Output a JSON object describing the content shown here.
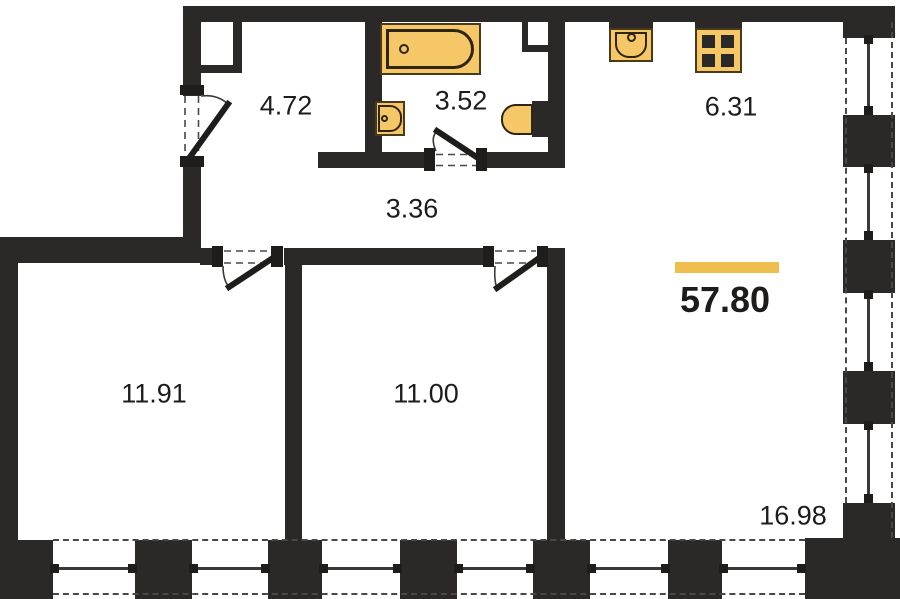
{
  "floor_plan": {
    "title": "apartment-floor-plan",
    "total_area": "57.80",
    "rooms": [
      {
        "name": "entry-hall",
        "area": "4.72"
      },
      {
        "name": "bathroom",
        "area": "3.52"
      },
      {
        "name": "corridor",
        "area": "3.36"
      },
      {
        "name": "kitchen",
        "area": "6.31"
      },
      {
        "name": "bedroom-1",
        "area": "11.91"
      },
      {
        "name": "bedroom-2",
        "area": "11.00"
      },
      {
        "name": "living-room",
        "area": "16.98"
      }
    ],
    "fixtures": [
      "bathtub-icon",
      "washbasin-icon",
      "toilet-icon",
      "kitchen-sink-icon",
      "stove-icon"
    ],
    "colors": {
      "wall": "#2b2927",
      "fixture_fill": "#f6c767",
      "fixture_outline": "#2e2514",
      "accent_bar": "#f0be4e",
      "label_text": "#1d1c1b"
    }
  }
}
